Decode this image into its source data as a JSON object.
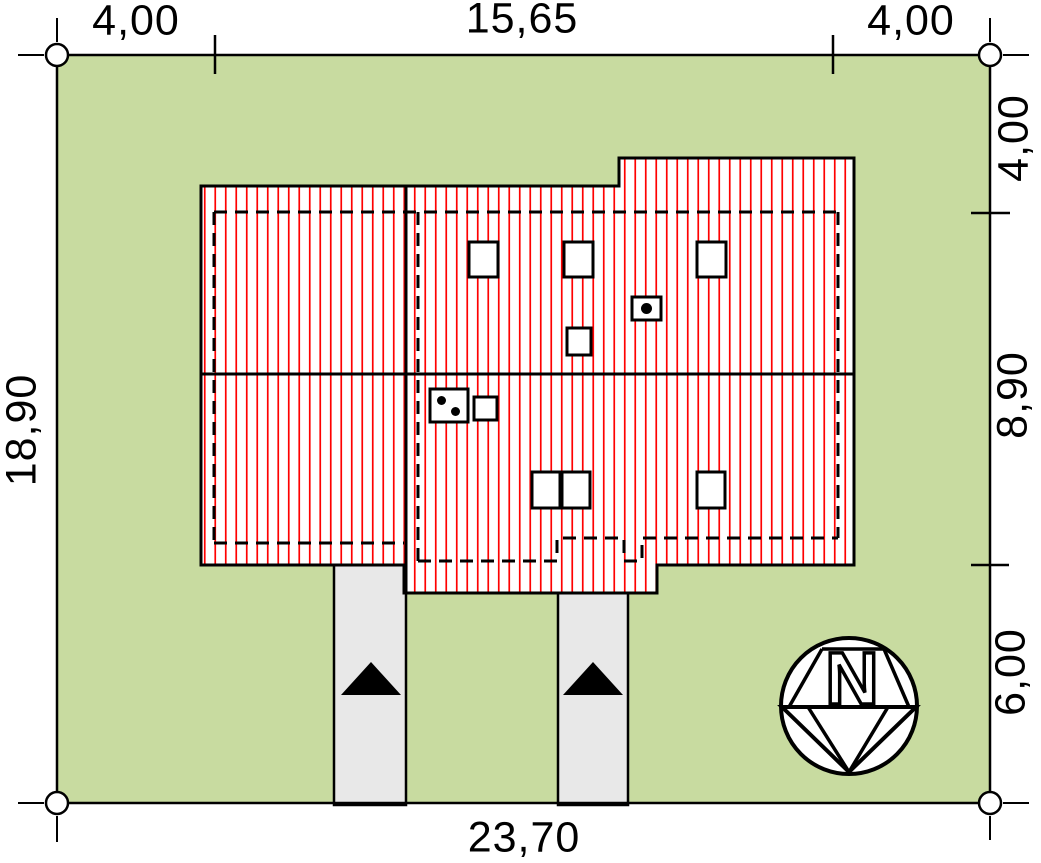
{
  "title": "House site plan with roof view and dimensions",
  "dimensions": {
    "top_left": "4,00",
    "top_middle": "15,65",
    "top_right": "4,00",
    "left_side": "18,90",
    "right_top": "4,00",
    "right_middle": "8,90",
    "right_bottom": "6,00",
    "bottom": "23,70"
  },
  "compass": {
    "label": "N"
  },
  "legend": {
    "plot": "green plot area",
    "roof": "red-striped roof plan",
    "driveways": "two gray access paths with entry arrows",
    "markers": "survey circles at plot corners"
  },
  "colors": {
    "plot_green": "#c8dba0",
    "roof_red": "#ff0000",
    "driveway_gray": "#e8e8e8",
    "line_black": "#000000",
    "paper_white": "#ffffff"
  }
}
